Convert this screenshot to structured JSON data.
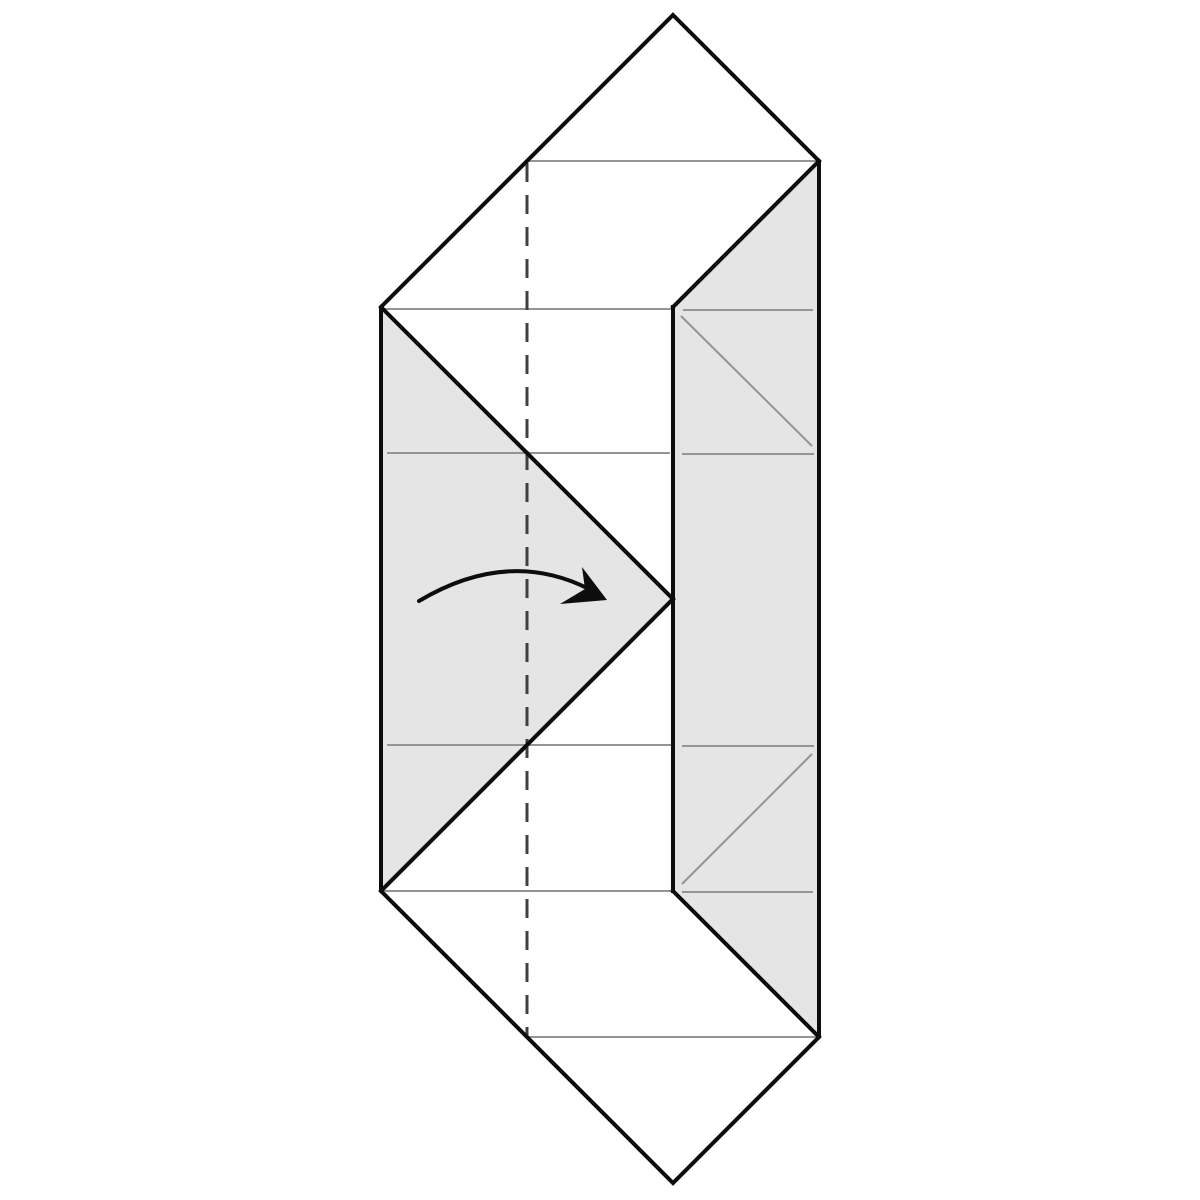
{
  "diagram": {
    "kind": "origami-fold-step",
    "canvas": {
      "width": 1200,
      "height": 1200,
      "background": "#ffffff"
    },
    "colors": {
      "outline": "#0d0d0d",
      "shade": "#e5e5e5",
      "crease": "#949494",
      "fold_dash": "#3f3f3f",
      "arrow": "#0d0d0d"
    },
    "stroke_widths": {
      "outline": 4,
      "interior_edge": 4,
      "crease": 2,
      "fold_dash": 3,
      "arrow": 4
    },
    "outline_points": "673,15 819,161 819,1037 673,1183 381,891 381,307",
    "shaded_regions": [
      {
        "name": "right-panel-shade",
        "points": "819,161 819,1037 673,891 673,307"
      },
      {
        "name": "left-flap-shade",
        "points": "381,307 673,599 381,891"
      }
    ],
    "interior_edges": [
      {
        "name": "edge-top-right-diagonal",
        "x1": 819,
        "y1": 161,
        "x2": 673,
        "y2": 307
      },
      {
        "name": "edge-inner-vertical",
        "x1": 673,
        "y1": 307,
        "x2": 673,
        "y2": 891
      },
      {
        "name": "edge-bottom-right-diagonal",
        "x1": 673,
        "y1": 891,
        "x2": 819,
        "y2": 1037
      },
      {
        "name": "edge-flap-upper-diagonal",
        "x1": 381,
        "y1": 307,
        "x2": 673,
        "y2": 599
      },
      {
        "name": "edge-flap-lower-diagonal",
        "x1": 673,
        "y1": 599,
        "x2": 381,
        "y2": 891
      }
    ],
    "crease_lines": [
      {
        "name": "crease-h-row1",
        "x1": 529,
        "y1": 161,
        "x2": 817,
        "y2": 161
      },
      {
        "name": "crease-h-row2-left",
        "x1": 384,
        "y1": 309,
        "x2": 671,
        "y2": 309
      },
      {
        "name": "crease-h-row2-right",
        "x1": 683,
        "y1": 310,
        "x2": 813,
        "y2": 310
      },
      {
        "name": "crease-h-row3-left",
        "x1": 387,
        "y1": 453,
        "x2": 670,
        "y2": 453
      },
      {
        "name": "crease-h-row3-right",
        "x1": 682,
        "y1": 454,
        "x2": 814,
        "y2": 454
      },
      {
        "name": "crease-h-row5-left",
        "x1": 387,
        "y1": 745,
        "x2": 671,
        "y2": 745
      },
      {
        "name": "crease-h-row5-right",
        "x1": 682,
        "y1": 746,
        "x2": 814,
        "y2": 746
      },
      {
        "name": "crease-h-row6-left",
        "x1": 383,
        "y1": 891,
        "x2": 671,
        "y2": 891
      },
      {
        "name": "crease-h-row6-right",
        "x1": 682,
        "y1": 892,
        "x2": 813,
        "y2": 892
      },
      {
        "name": "crease-h-row7",
        "x1": 529,
        "y1": 1037,
        "x2": 817,
        "y2": 1037
      },
      {
        "name": "crease-diag-upper-right",
        "x1": 681,
        "y1": 316,
        "x2": 812,
        "y2": 446
      },
      {
        "name": "crease-diag-lower-right",
        "x1": 682,
        "y1": 884,
        "x2": 812,
        "y2": 754
      }
    ],
    "fold_line": {
      "name": "valley-fold-dashed-line",
      "x1": 527,
      "y1": 163,
      "x2": 527,
      "y2": 1036,
      "dash": "19 13"
    },
    "fold_arrow": {
      "name": "fold-direction-arrow",
      "tail_path": "M 419 601 Q 508 548 589 589",
      "head_points": "607,600 582,567 585,589 560,604"
    }
  }
}
